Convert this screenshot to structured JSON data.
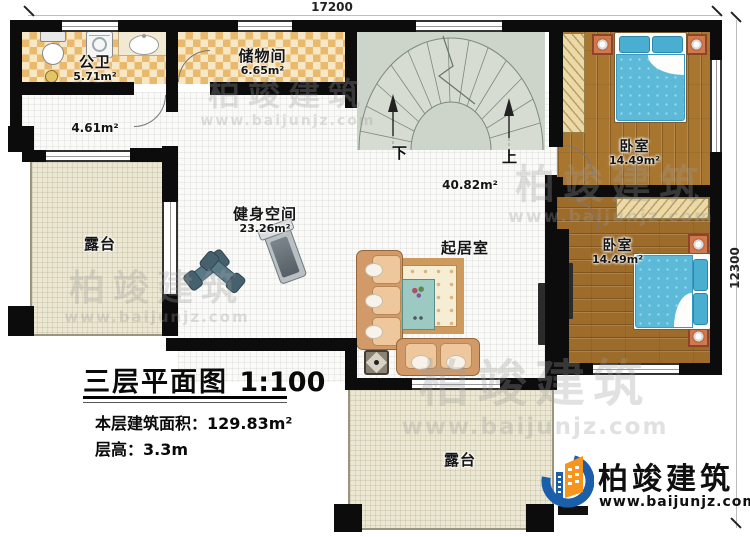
{
  "dimensions": {
    "top": "17200",
    "right": "12300"
  },
  "rooms": {
    "bathroom": {
      "name": "公卫",
      "area": "5.71m²"
    },
    "storage": {
      "name": "储物间",
      "area": "6.65m²"
    },
    "hallway": {
      "area": "4.61m²"
    },
    "terrace_left": {
      "name": "露台"
    },
    "gym": {
      "name": "健身空间",
      "area": "23.26m²"
    },
    "living": {
      "name": "起居室",
      "area": "40.82m²"
    },
    "bedroom_top": {
      "name": "卧室",
      "area": "14.49m²"
    },
    "bedroom_bottom": {
      "name": "卧室",
      "area": "14.49m²"
    },
    "terrace_bottom": {
      "name": "露台"
    }
  },
  "stairs": {
    "down": "下",
    "up": "上"
  },
  "title_block": {
    "title": "三层平面图",
    "scale": "1:100",
    "area_label": "本层建筑面积：",
    "area_value": "129.83m²",
    "height_label": "层高：",
    "height_value": "3.3m"
  },
  "logo": {
    "name": "柏竣建筑",
    "website": "www.baijunjz.com"
  },
  "watermark": {
    "name": "柏竣建筑",
    "website": "www.baijunjz.com"
  },
  "colors": {
    "wall": "#0c0c0c",
    "logo_blue": "#1b5ea9",
    "logo_orange": "#f7941d",
    "bed_blue": "#5cb9d8",
    "wood_floor": "#a9762f",
    "tile_orange": "#e9ba6e",
    "terrace_beige": "#ebe7d3",
    "stair_grey": "#cdd4c9"
  }
}
